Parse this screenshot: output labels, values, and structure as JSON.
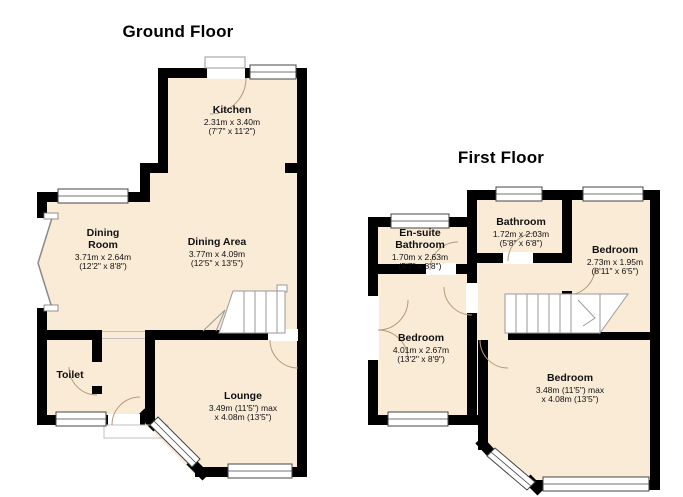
{
  "ground_floor": {
    "title": "Ground Floor",
    "rooms": {
      "kitchen": {
        "name": "Kitchen",
        "dims1": "2.31m x 3.40m",
        "dims2": "(7'7\" x 11'2\")"
      },
      "dining_room": {
        "name": "Dining Room",
        "dims1": "3.71m x 2.64m",
        "dims2": "(12'2\" x 8'8\")"
      },
      "dining_area": {
        "name": "Dining Area",
        "dims1": "3.77m x 4.09m",
        "dims2": "(12'5\" x 13'5\")"
      },
      "toilet": {
        "name": "Toilet"
      },
      "lounge": {
        "name": "Lounge",
        "dims1": "3.49m (11'5\") max",
        "dims2": "x 4.08m (13'5\")"
      }
    }
  },
  "first_floor": {
    "title": "First Floor",
    "rooms": {
      "ensuite_bathroom": {
        "name": "En-suite Bathroom",
        "dims1": "1.70m x 2.63m",
        "dims2": "(5'7\" x 8'8\")"
      },
      "bathroom": {
        "name": "Bathroom",
        "dims1": "1.72m x 2.03m",
        "dims2": "(5'8\" x 6'8\")"
      },
      "bedroom_small": {
        "name": "Bedroom",
        "dims1": "2.73m x 1.95m",
        "dims2": "(8'11\" x 6'5\")"
      },
      "bedroom_mid": {
        "name": "Bedroom",
        "dims1": "4.01m x 2.67m",
        "dims2": "(13'2\" x 8'9\")"
      },
      "bedroom_main": {
        "name": "Bedroom",
        "dims1": "3.48m (11'5\") max",
        "dims2": "x 4.08m (13'5\")"
      }
    }
  },
  "colors": {
    "room_fill": "#FAEBD7",
    "wall": "#000000",
    "door_arc": "#b39a78",
    "background": "#ffffff"
  }
}
